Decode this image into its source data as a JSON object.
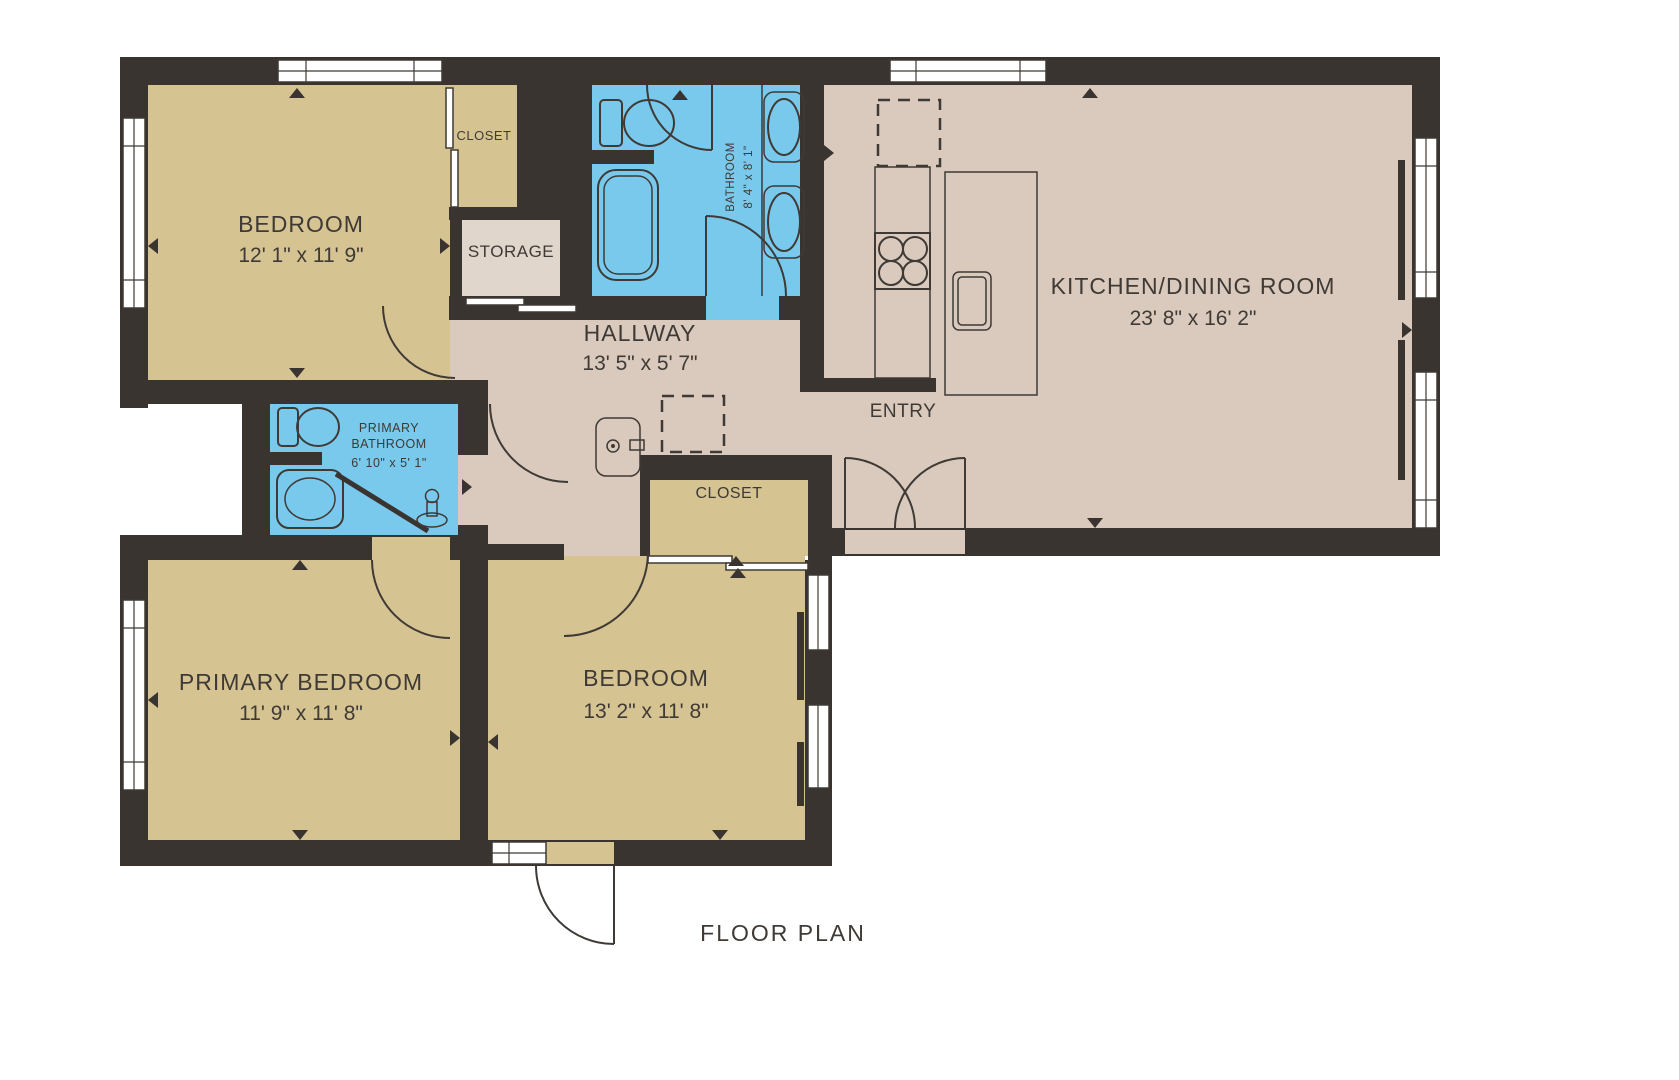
{
  "title": "FLOOR PLAN",
  "colors": {
    "wall": "#393430",
    "outline": "#3f3a35",
    "text": "#3f3a35",
    "room-tan": "#d5c392",
    "floor-beige": "#d9cabd",
    "storage-beige": "#e1d6cc",
    "bath-blue": "#79c9ed",
    "paper": "#ffffff"
  },
  "rooms": [
    {
      "name": "BEDROOM",
      "dims": "12' 1\" x 11' 9\""
    },
    {
      "name": "CLOSET"
    },
    {
      "name": "STORAGE"
    },
    {
      "name": "BATHROOM",
      "dims": "8' 4\" x 8' 1\""
    },
    {
      "name": "KITCHEN/DINING ROOM",
      "dims": "23' 8\" x 16' 2\""
    },
    {
      "name": "HALLWAY",
      "dims": "13' 5\" x 5' 7\""
    },
    {
      "name": "ENTRY"
    },
    {
      "name": "PRIMARY BATHROOM",
      "lines": [
        "PRIMARY",
        "BATHROOM"
      ],
      "dims": "6' 10\" x 5' 1\""
    },
    {
      "name": "CLOSET"
    },
    {
      "name": "PRIMARY BEDROOM",
      "dims": "11' 9\" x 11' 8\""
    },
    {
      "name": "BEDROOM",
      "dims": "13' 2\" x 11' 8\""
    }
  ]
}
